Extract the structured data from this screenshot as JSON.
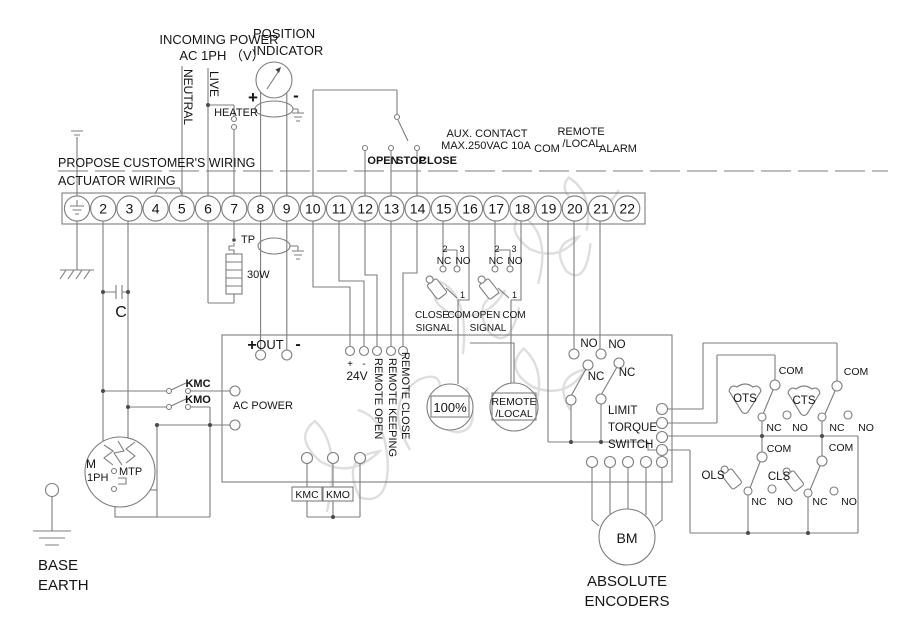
{
  "header": {
    "incoming_power_1": "INCOMING POWER",
    "incoming_power_2": "AC 1PH （V）",
    "position_1": "POSITION",
    "position_2": "INDICATOR",
    "neutral": "NEUTRAL",
    "live": "LIVE",
    "heater": "HEATER"
  },
  "common": {
    "plus": "+",
    "minus": "-",
    "nc": "NC",
    "no": "NO",
    "com": "COM",
    "n1": "1",
    "n2": "2",
    "n3": "3"
  },
  "boundary": {
    "customer_side": "PROPOSE CUSTOMER'S WIRING",
    "actuator_side": "ACTUATOR WIRING"
  },
  "terminal_strip": {
    "labels": [
      "",
      "2",
      "3",
      "4",
      "5",
      "6",
      "7",
      "8",
      "9",
      "10",
      "11",
      "12",
      "13",
      "14",
      "15",
      "16",
      "17",
      "18",
      "19",
      "20",
      "21",
      "22"
    ]
  },
  "strip_top": {
    "open": "OPEN",
    "stop": "STOP",
    "close": "CLOSE",
    "aux_1": "AUX. CONTACT",
    "aux_2": "MAX.250VAC 10A",
    "com": "COM",
    "remote": "REMOTE",
    "local": "/LOCAL",
    "alarm": "ALARM"
  },
  "heater_circuit": {
    "tp": "TP",
    "watts": "30W"
  },
  "motor_circuit": {
    "capacitor": "C",
    "kmc": "KMC",
    "kmo": "KMO",
    "motor": "M",
    "phase": "1PH",
    "mtp": "MTP",
    "base_1": "BASE",
    "base_2": "EARTH"
  },
  "aux_contacts": {
    "close_1": "CLOSE",
    "open_1": "OPEN",
    "signal": "SIGNAL"
  },
  "control_box": {
    "out": "OUT",
    "v24": "24V",
    "remote_open": "REMOTE OPEN",
    "remote_keeping": "REMOTE KEEPING",
    "remote_close": "REMOTE CLOSE",
    "ac_power": "AC POWER",
    "percent": "100%",
    "rl_1": "REMOTE",
    "rl_2": "/LOCAL",
    "limit_1": "LIMIT",
    "limit_2": "TORQUE",
    "limit_3": "SWITCH",
    "kmc": "KMC",
    "kmo": "KMO"
  },
  "limit_switches": {
    "ots": "OTS",
    "cts": "CTS",
    "ols": "OLS",
    "cls": "CLS"
  },
  "encoder": {
    "bm": "BM",
    "label_1": "ABSOLUTE",
    "label_2": "ENCODERS"
  }
}
